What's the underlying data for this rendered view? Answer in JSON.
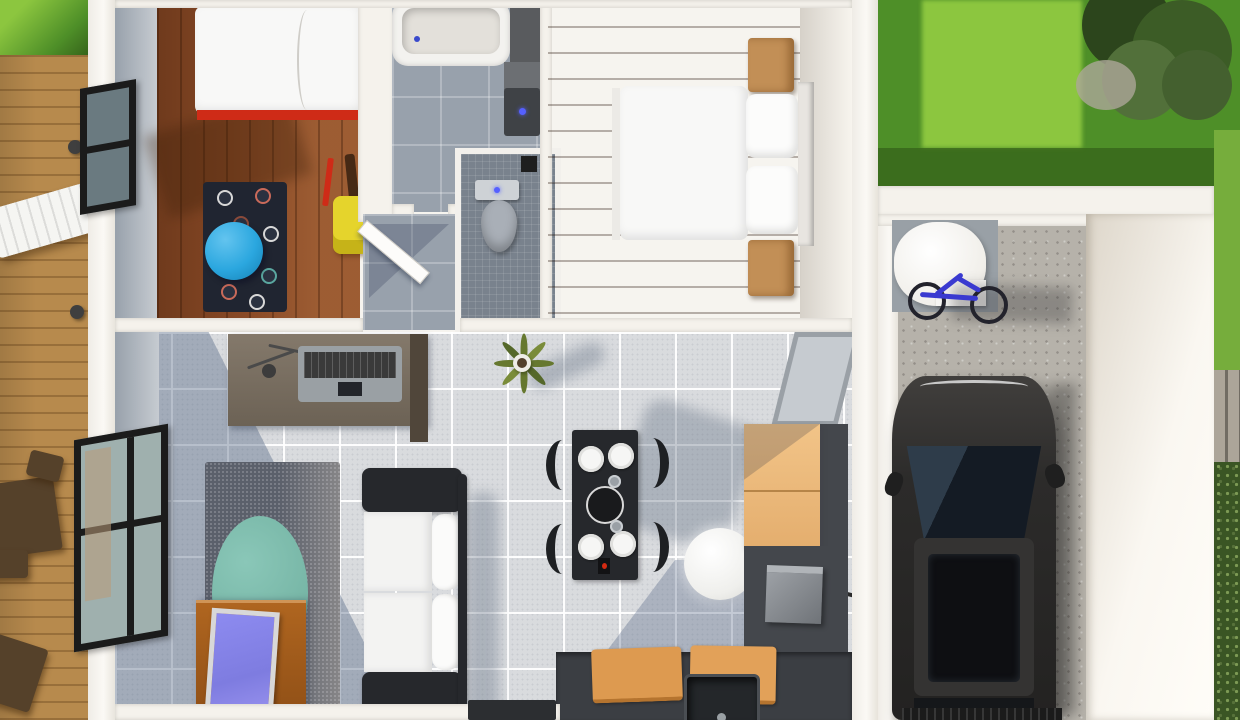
{
  "title": "3D rendered top-down floor plan of a small house with deck, garden and garage",
  "colors": {
    "grass": "#4e8f28",
    "grass_lit": "#8cc63f",
    "grass_shadow": "#35621a",
    "deck_wood": "#b78a4d",
    "kids_wood": "#8a4a26",
    "rug_navy": "#202531",
    "pouf_blue": "#2ba7df",
    "chair_yellow": "#e5d42c",
    "red_accent": "#cf2b17",
    "bed_white": "#f8f8f7",
    "bath_tile": "#98a1ac",
    "wc_tile": "#79828d",
    "nightstand": "#c28f56",
    "tile": "#d9dbde",
    "rug_gray": "#5b606b",
    "rug_teal": "#76b5a5",
    "sofa_frame": "#26282c",
    "cushion_white": "#f3f3f2",
    "table_black": "#26282c",
    "counter_dark": "#3b3e43",
    "concrete": "#b6b2aa",
    "bike_blue": "#3a3ad0",
    "bush": "#3a5524"
  },
  "rooms": {
    "kids_bedroom": {
      "label": "Kids bedroom",
      "furniture": [
        "single bed with red frame",
        "dark polka-dot rug",
        "blue round pouf",
        "yellow kids chair",
        "window"
      ]
    },
    "bathroom": {
      "label": "Bathroom",
      "furniture": [
        "bathtub",
        "wall vanity with sink"
      ]
    },
    "wc": {
      "label": "Toilet room",
      "furniture": [
        "toilet"
      ]
    },
    "hallway": {
      "label": "Hallway",
      "furniture": [
        "open white door"
      ]
    },
    "master_bedroom": {
      "label": "Master bedroom",
      "furniture": [
        "double bed with two pillows",
        "two wooden nightstands"
      ]
    },
    "living_room": {
      "label": "Living room",
      "furniture": [
        "desk with laptop and lamp",
        "window",
        "wooden TV sideboard",
        "TV",
        "gray speckled rug",
        "teal oval rug",
        "black and white sofa",
        "potted plant"
      ]
    },
    "dining_area": {
      "label": "Dining area",
      "furniture": [
        "black dining table",
        "four black chairs",
        "four white plates",
        "white globe floor lamp"
      ]
    },
    "kitchen": {
      "label": "Kitchen",
      "furniture": [
        "light wood cabinets",
        "dark counter",
        "sink",
        "cutting boards",
        "gray appliance",
        "window"
      ]
    },
    "garage": {
      "label": "Garage",
      "furniture": [
        "black car",
        "blue bicycle",
        "white storage tank",
        "concrete floor"
      ]
    }
  },
  "outdoor": {
    "deck": {
      "label": "Wooden deck",
      "furniture": [
        "white sun lounger",
        "dark bistro table and chairs"
      ]
    },
    "lawn": {
      "label": "Back lawn with tree"
    },
    "path": {
      "label": "Stone paver path"
    },
    "shrubs": {
      "label": "Shrubs"
    }
  }
}
